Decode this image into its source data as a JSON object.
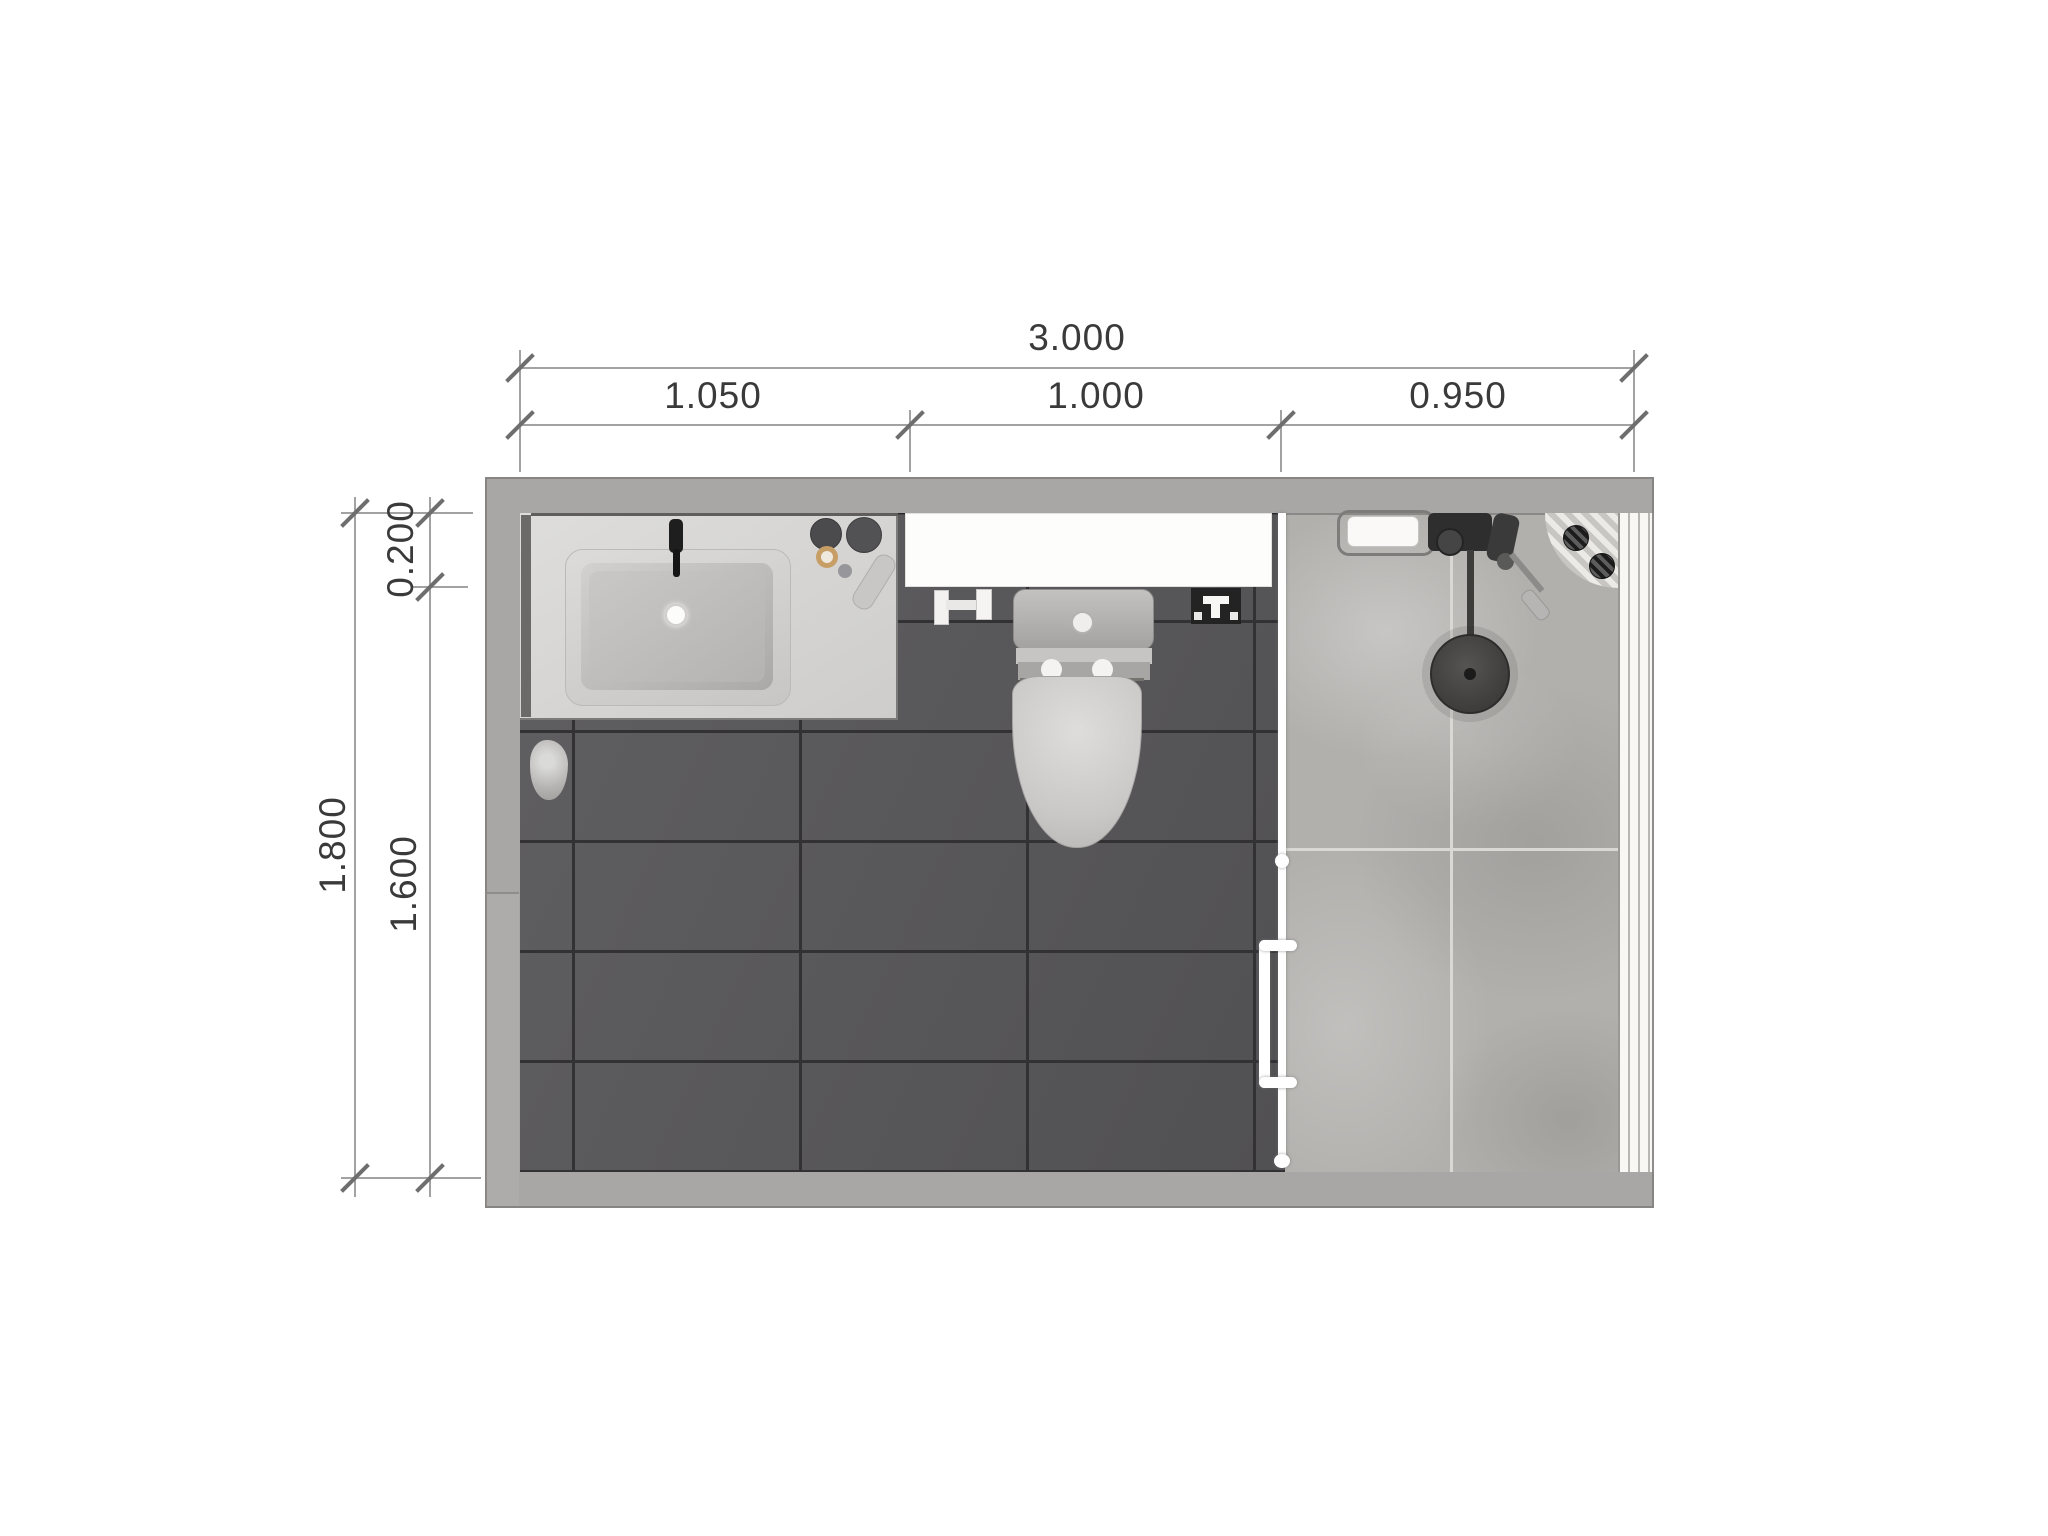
{
  "drawing": {
    "type": "bathroom-floor-plan-top-view",
    "scale_px_per_m": 371
  },
  "dims": {
    "top_overall": "3.000",
    "top_seg1": "1.050",
    "top_seg2": "1.000",
    "top_seg3": "0.950",
    "left_overall": "1.800",
    "left_seg_top": "0.200",
    "left_seg_bottom": "1.600"
  },
  "fixtures": {
    "vanity_counter": "vanity-countertop",
    "sink": "rectangular-undermount-sink",
    "faucet": "black-faucet",
    "toilet": "one-piece-toilet",
    "shelf": "white-shelf-over-toilet",
    "paper_holder": "toilet-paper-holder",
    "sprayer": "bidet-sprayer",
    "glass_partition": "shower-glass-partition",
    "door_handle": "shower-door-handle",
    "shower_head": "rain-shower-head",
    "shower_mixer": "shower-mixer-valve",
    "soap_tray": "soap-tray",
    "corner_caddy": "corner-drain-caddy",
    "louver": "louvered-panel",
    "decor": "floor-decor-item"
  },
  "colors": {
    "wall": "#a9a6a6",
    "floor_dark_tile": "#575659",
    "floor_dark_grout": "#323134",
    "shower_stone": "#b2b0ad",
    "shower_grout": "#d9d8d4",
    "counter": "#d8d7d5",
    "fixture_white": "#fdfdfc",
    "dim_line": "#a2a2a2",
    "dim_text": "#3a3a3a"
  }
}
